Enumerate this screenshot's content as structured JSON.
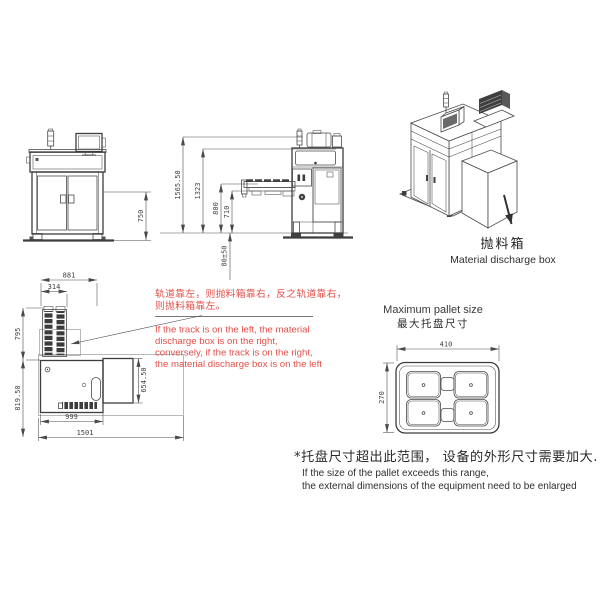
{
  "colors": {
    "line": "#4a4a4a",
    "line_light": "#9a9a9a",
    "accent_red": "#e2504a",
    "text": "#2f2f2f",
    "background": "#ffffff"
  },
  "front_view": {
    "dim_table_height": "750",
    "dim_total_height": "1565.50"
  },
  "side_view": {
    "dim_frame_height": "1323",
    "dim_arm_height": "800",
    "dim_track_height": "710",
    "dim_feet_range": "80±50"
  },
  "top_view": {
    "dim_overall_width": "881",
    "dim_track_width": "314",
    "dim_track_depth": "795",
    "dim_body_depth": "819.50",
    "dim_discharge_depth": "654.50",
    "dim_body_width": "999",
    "dim_footprint_width": "1501"
  },
  "iso_view": {
    "label_cn": "抛料箱",
    "label_en": "Material discharge box"
  },
  "red_note": {
    "cn_line1": "轨道靠左，则抛料箱靠右，反之轨道靠右，",
    "cn_line2": "则抛料箱靠左。",
    "en_line1": "If the track is on the left, the material",
    "en_line2": "discharge box is on the right,",
    "en_line3": "conversely, if the track is on the right,",
    "en_line4": "the material discharge box is on the left"
  },
  "pallet": {
    "title_en": "Maximum pallet size",
    "title_cn": "最大托盘尺寸",
    "dim_width": "410",
    "dim_height": "270"
  },
  "footnote": {
    "cn": "*托盘尺寸超出此范围， 设备的外形尺寸需要加大.",
    "en_line1": "If the size of the pallet exceeds this range,",
    "en_line2": "the external dimensions of the equipment need to be enlarged"
  }
}
